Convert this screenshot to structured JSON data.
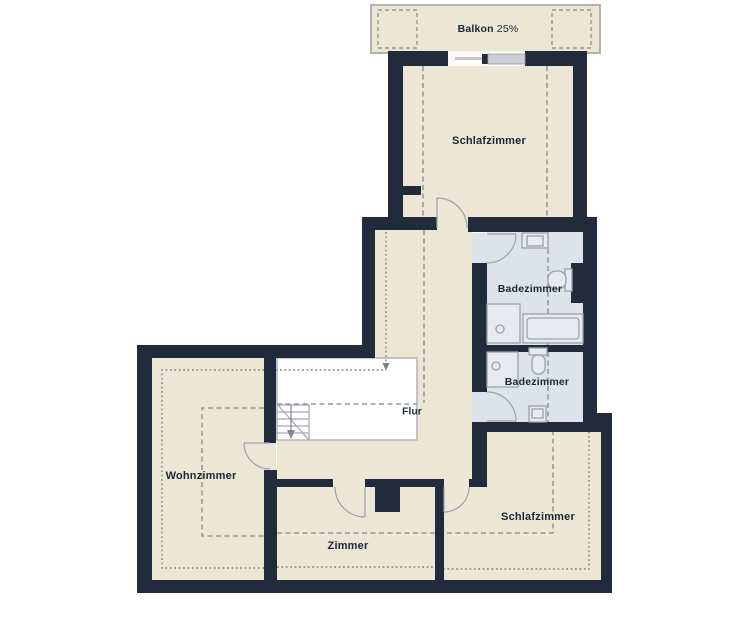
{
  "labels": {
    "balkon": "Balkon",
    "balkon_value": "25%",
    "schlafzimmer_top": "Schlafzimmer",
    "badezimmer_upper": "Badezimmer",
    "badezimmer_lower": "Badezimmer",
    "flur": "Flur",
    "wohnzimmer": "Wohnzimmer",
    "zimmer": "Zimmer",
    "schlafzimmer_bottom": "Schlafzimmer"
  },
  "colors": {
    "wall": "#222b3b",
    "floor": "#ece6d4",
    "bathroom_floor": "#dee2eb",
    "stairwell": "#ffffff",
    "fixture_outline": "#9ba1ab",
    "guide_dashed": "#83878f",
    "guide_dotted": "#7d828a",
    "label_text": "#1c2637",
    "balcony_border": "#b3b2ae"
  }
}
